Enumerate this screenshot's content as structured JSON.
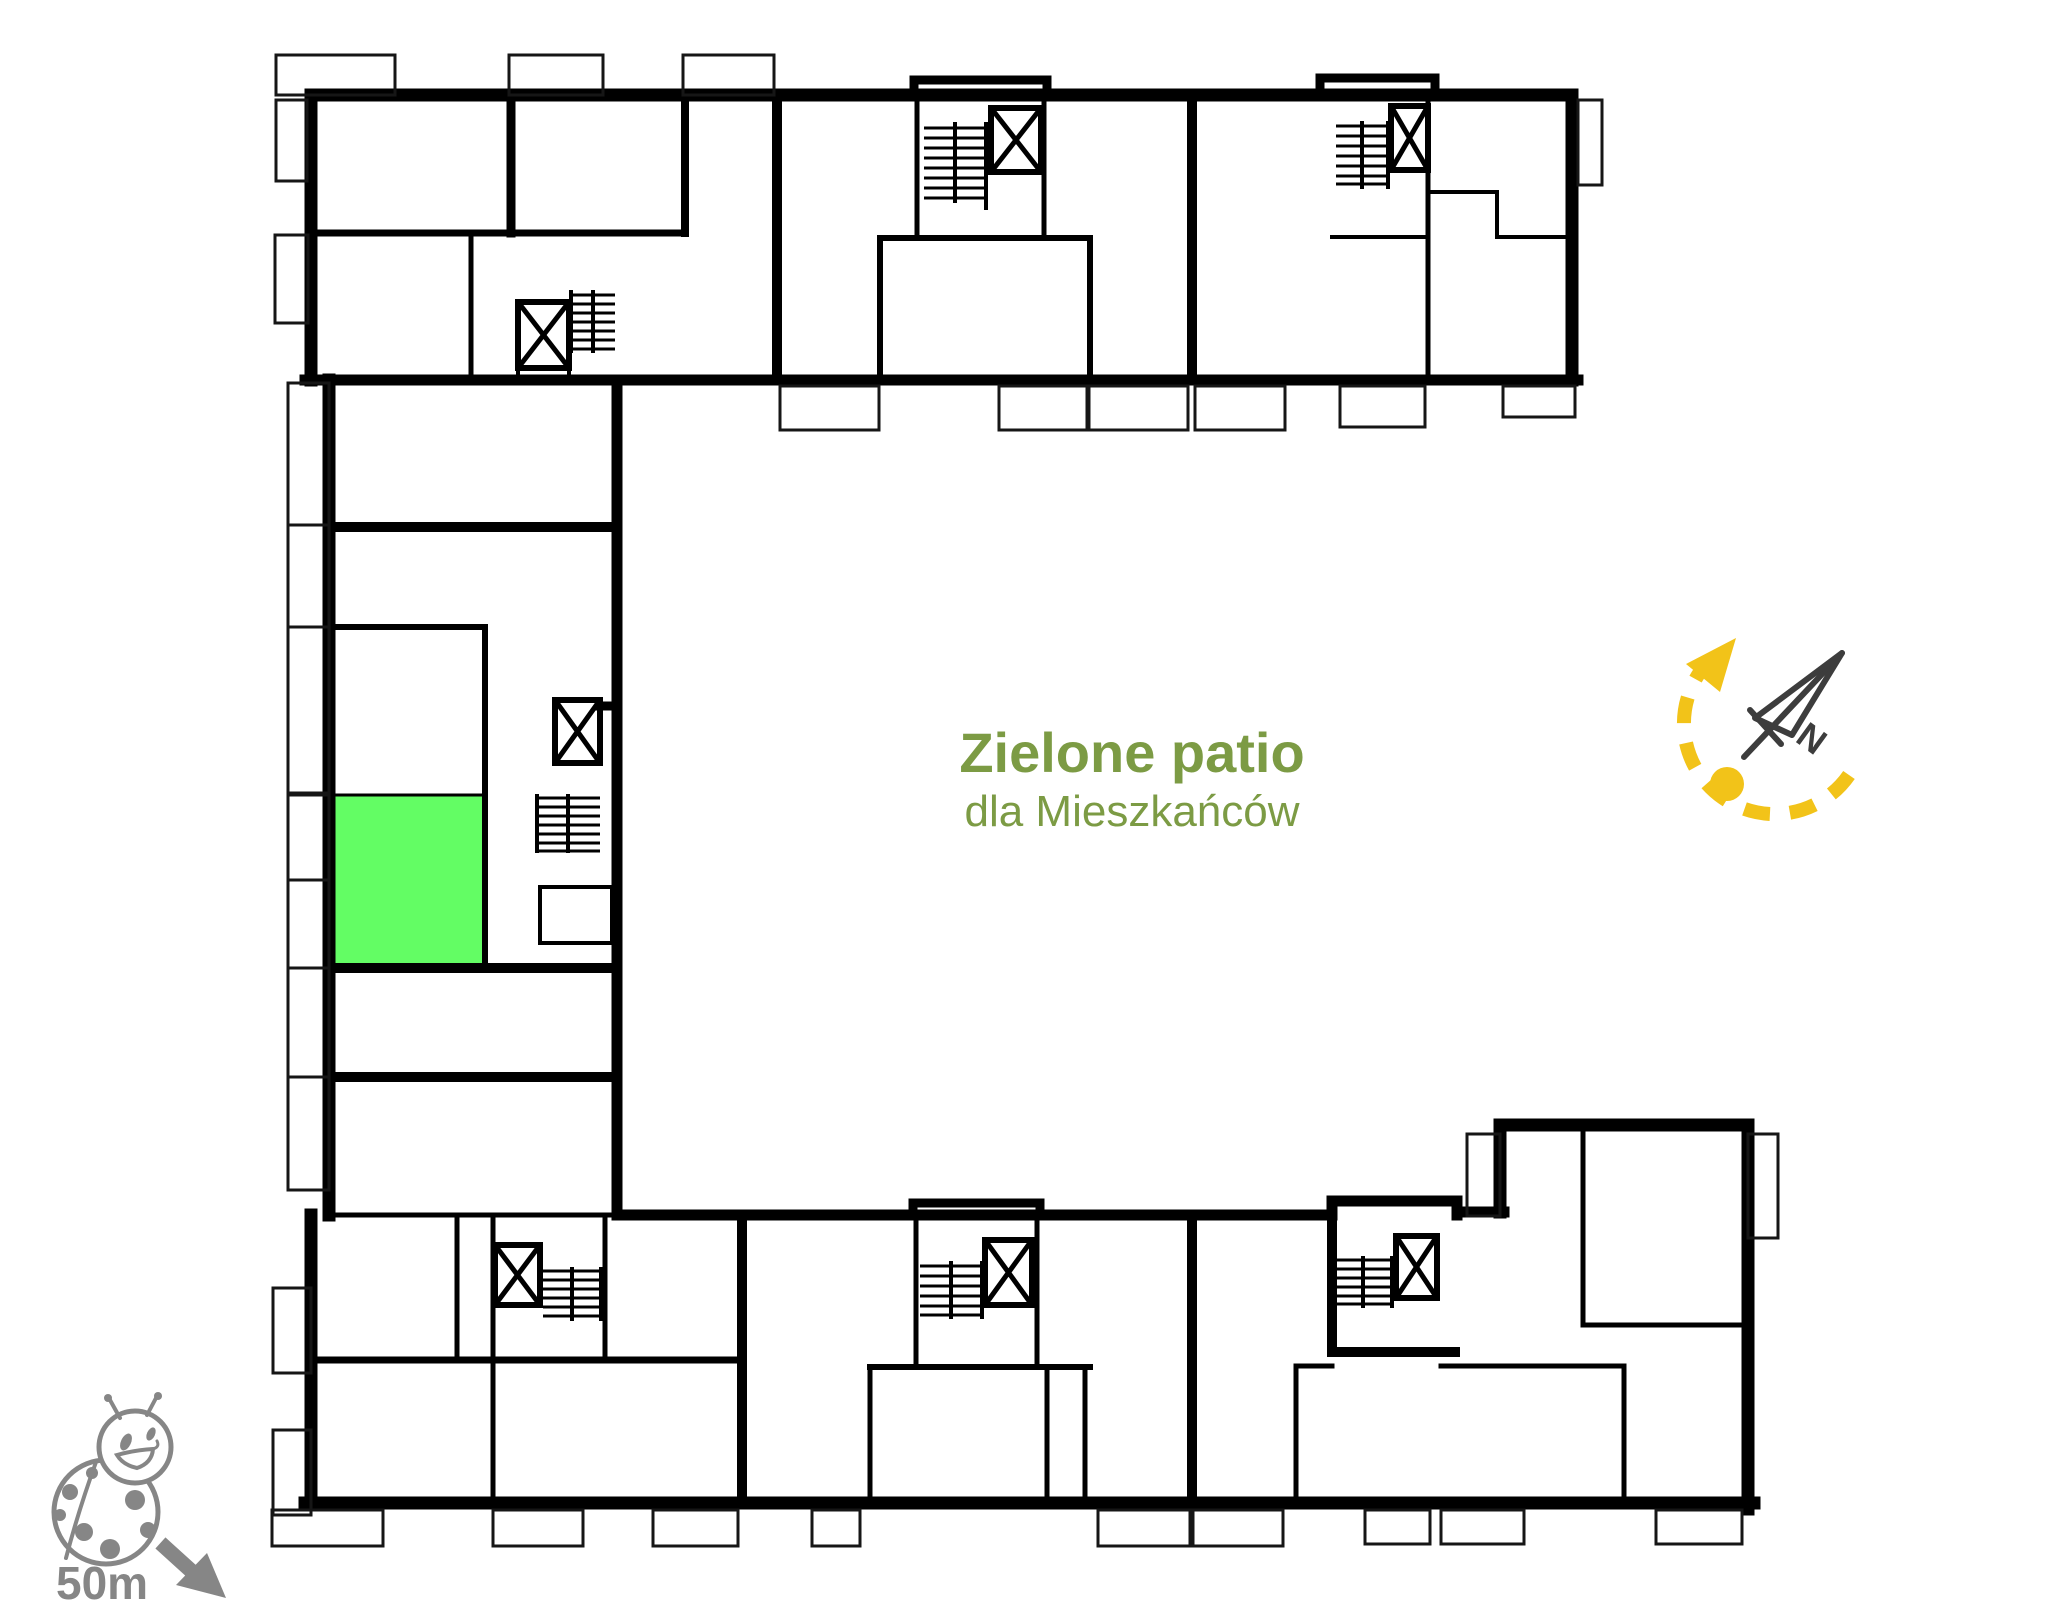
{
  "patio_label": {
    "title": "Zielone patio",
    "subtitle": "dla Mieszkańców",
    "color": "#7c9b44"
  },
  "compass": {
    "north_label": "N",
    "needle_color": "#3d3d3d",
    "route_color": "#f2c319"
  },
  "scale_indicator": {
    "distance_label": "50m",
    "color": "#868686"
  },
  "floor_plan": {
    "background": "#ffffff",
    "wall_color": "#000000",
    "highlight_color": "#63fd64",
    "highlight_border": "#44c944"
  }
}
